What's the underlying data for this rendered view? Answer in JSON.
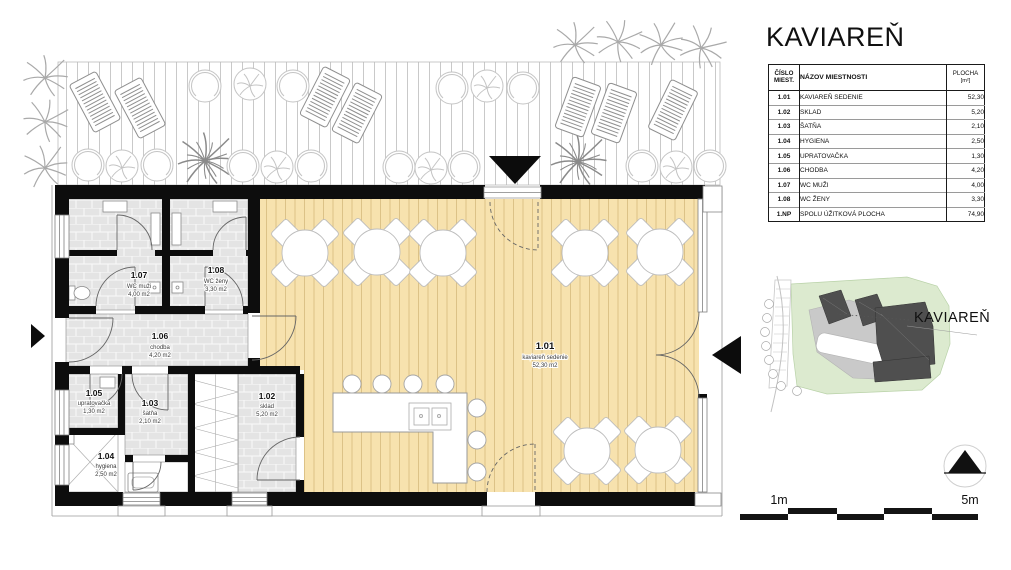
{
  "title": "KAVIAREŇ",
  "room_table": {
    "header": {
      "col_number_line1": "ČÍSLO",
      "col_number_line2": "MIEST.",
      "col_name": "NÁZOV MIESTNOSTI",
      "col_area_line1": "PLOCHA",
      "col_area_line2": "[m²]"
    },
    "rows": [
      {
        "number": "1.01",
        "name": "KAVIAREŇ SEDENIE",
        "area": "52,30"
      },
      {
        "number": "1.02",
        "name": "SKLAD",
        "area": "5,20"
      },
      {
        "number": "1.03",
        "name": "ŠATŇA",
        "area": "2,10"
      },
      {
        "number": "1.04",
        "name": "HYGIENA",
        "area": "2,50"
      },
      {
        "number": "1.05",
        "name": "UPRATOVAČKA",
        "area": "1,30"
      },
      {
        "number": "1.06",
        "name": "CHODBA",
        "area": "4,20"
      },
      {
        "number": "1.07",
        "name": "WC MUŽI",
        "area": "4,00"
      },
      {
        "number": "1.08",
        "name": "WC ŽENY",
        "area": "3,30"
      }
    ],
    "total_row": {
      "number": "1.NP",
      "name": "SPOLU ÚŽITKOVÁ PLOCHA",
      "area": "74,90"
    }
  },
  "floor_plan": {
    "rooms": [
      {
        "number": "1.01",
        "name": "kaviareň sedenie",
        "area": "52,30 m2"
      },
      {
        "number": "1.02",
        "name": "sklad",
        "area": "5,20 m2"
      },
      {
        "number": "1.03",
        "name": "šatňa",
        "area": "2,10 m2"
      },
      {
        "number": "1.04",
        "name": "hygiena",
        "area": "2,50 m2"
      },
      {
        "number": "1.05",
        "name": "upratovačka",
        "area": "1,30 m2"
      },
      {
        "number": "1.06",
        "name": "chodba",
        "area": "4,20 m2"
      },
      {
        "number": "1.07",
        "name": "WC muži",
        "area": "4,00 m2"
      },
      {
        "number": "1.08",
        "name": "WC ženy",
        "area": "3,30 m2"
      }
    ]
  },
  "site_plan": {
    "label": "KAVIAREŇ"
  },
  "scale_bar": {
    "left_label": "1m",
    "right_label": "5m"
  },
  "colors": {
    "cafe_floor": "#F7E2AE",
    "plank_line": "#DCC287",
    "tile_floor": "#E4E4E4",
    "wall": "#0d0d0d",
    "site_green": "#DCEACF",
    "site_building": "#4F4F4F"
  }
}
